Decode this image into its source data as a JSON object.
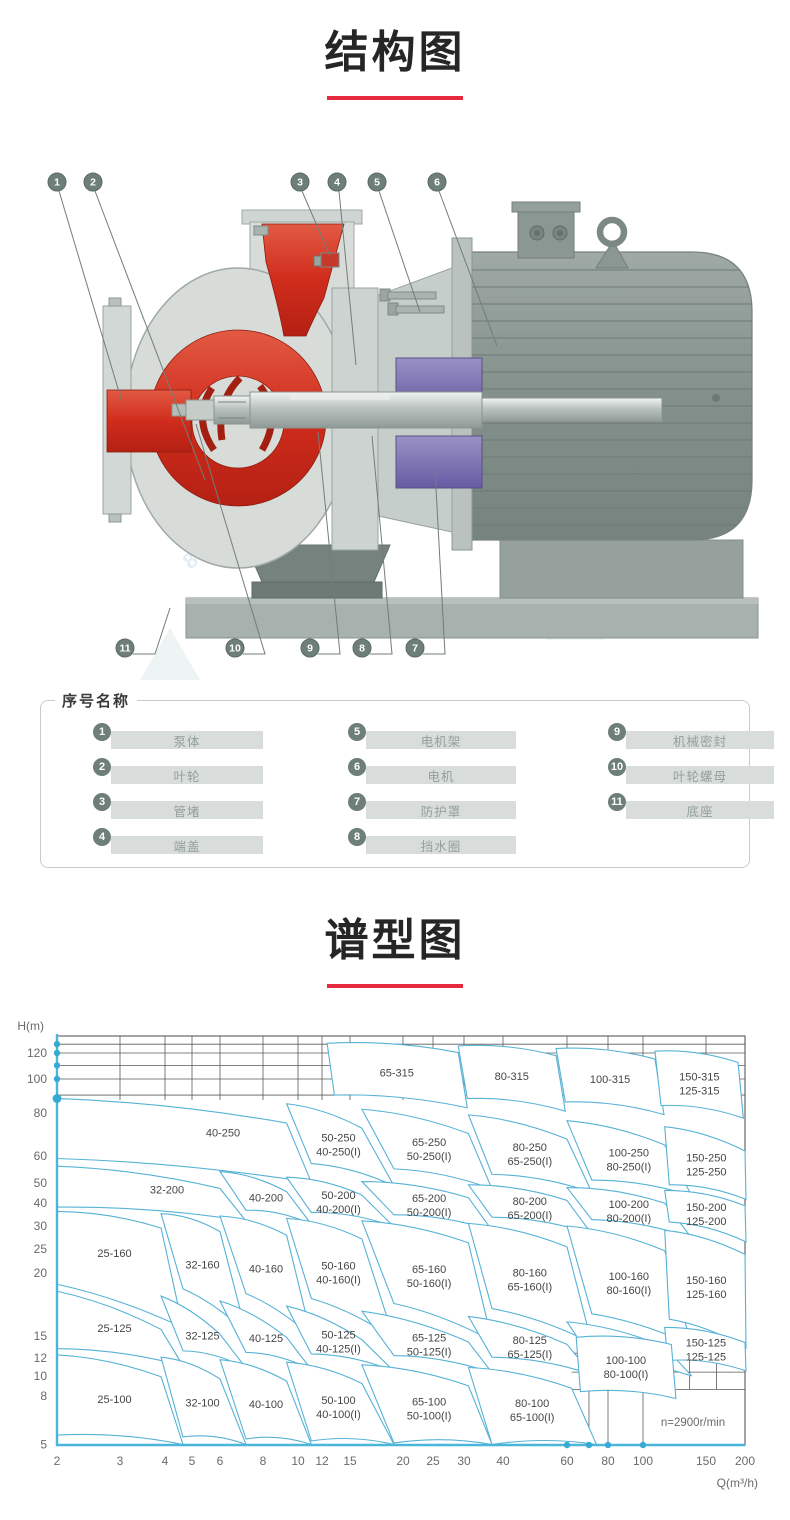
{
  "page": {
    "accent_red": "#e5293e"
  },
  "sections": {
    "structure": {
      "title": "结构图"
    },
    "spectrum": {
      "title": "谱型图"
    }
  },
  "structure": {
    "callouts_top": [
      "1",
      "2",
      "3",
      "4",
      "5",
      "6"
    ],
    "callouts_bottom": [
      "11",
      "10",
      "9",
      "8",
      "7"
    ],
    "watermark_text": "8570"
  },
  "legend": {
    "title": "序号名称",
    "columns": [
      [
        {
          "num": "1",
          "label": "泵体"
        },
        {
          "num": "2",
          "label": "叶轮"
        },
        {
          "num": "3",
          "label": "管堵"
        },
        {
          "num": "4",
          "label": "端盖"
        }
      ],
      [
        {
          "num": "5",
          "label": "电机架"
        },
        {
          "num": "6",
          "label": "电机"
        },
        {
          "num": "7",
          "label": "防护罩"
        },
        {
          "num": "8",
          "label": "挡水圈"
        }
      ],
      [
        {
          "num": "9",
          "label": "机械密封"
        },
        {
          "num": "10",
          "label": "叶轮螺母"
        },
        {
          "num": "11",
          "label": "底座"
        }
      ]
    ]
  },
  "chart_data": {
    "type": "area",
    "title": "谱型图",
    "xlabel": "Q(m³/h)",
    "ylabel": "H(m)",
    "scale": "log-log",
    "x_range": [
      2,
      200
    ],
    "y_range": [
      5,
      140
    ],
    "annotation": "n=2900r/min",
    "x_ticks": [
      2,
      3,
      4,
      5,
      6,
      8,
      10,
      12,
      15,
      20,
      25,
      30,
      40,
      60,
      80,
      100,
      150,
      200
    ],
    "y_ticks": [
      120,
      100,
      80,
      60,
      50,
      40,
      30,
      25,
      20,
      15,
      12,
      10,
      8,
      5
    ],
    "grid_top_h": [
      130,
      120,
      110,
      100,
      90
    ],
    "colors": {
      "axis": "#49b6da",
      "region_stroke": "#57b2d6",
      "grid": "#5a5a5a",
      "tick": "#6a6a6a",
      "label": "#454545"
    },
    "regions": [
      {
        "t": [
          "65-315"
        ],
        "q1": 12.5,
        "q2": 29,
        "hT": 131,
        "hB": 90,
        "s": 1.06,
        "d": 0.92
      },
      {
        "t": [
          "80-315"
        ],
        "q1": 29,
        "q2": 56,
        "hT": 128,
        "hB": 88,
        "s": 1.06,
        "d": 0.92
      },
      {
        "t": [
          "100-315"
        ],
        "q1": 56,
        "q2": 108,
        "hT": 125,
        "hB": 86,
        "s": 1.06,
        "d": 0.92
      },
      {
        "t": [
          "150-315",
          "125-315"
        ],
        "q1": 108,
        "q2": 190,
        "hT": 122,
        "hB": 84,
        "s": 1.04,
        "d": 0.92
      },
      {
        "t": [
          "40-250"
        ],
        "q1": 2,
        "q2": 9.3,
        "hT": 88,
        "hB": 59,
        "sl": 1,
        "d": 0.85,
        "dx": 45,
        "dy": -6
      },
      {
        "t": [
          "50-250",
          "40-250(I)"
        ],
        "q1": 9.3,
        "q2": 16,
        "hT": 85,
        "hB": 57,
        "d": 0.85
      },
      {
        "t": [
          "65-250",
          "50-250(I)"
        ],
        "q1": 16,
        "q2": 31,
        "hT": 82,
        "hB": 55,
        "d": 0.85
      },
      {
        "t": [
          "80-250",
          "65-250(I)"
        ],
        "q1": 31,
        "q2": 60,
        "hT": 79,
        "hB": 53,
        "d": 0.85
      },
      {
        "t": [
          "100-250",
          "80-250(I)"
        ],
        "q1": 60,
        "q2": 115,
        "hT": 76,
        "hB": 51,
        "d": 0.85
      },
      {
        "t": [
          "150-250",
          "125-250"
        ],
        "q1": 115,
        "q2": 200,
        "hT": 73,
        "hB": 49,
        "s": 1.03,
        "d": 0.85
      },
      {
        "t": [
          "32-200"
        ],
        "q1": 2,
        "q2": 6,
        "hT": 56,
        "hB": 38,
        "sl": 1,
        "dx": 22,
        "dy": -4
      },
      {
        "t": [
          "40-200"
        ],
        "q1": 6,
        "q2": 9.3,
        "hT": 54,
        "hB": 36.5
      },
      {
        "t": [
          "50-200",
          "40-200(I)"
        ],
        "q1": 9.3,
        "q2": 16,
        "hT": 52,
        "hB": 35.5
      },
      {
        "t": [
          "65-200",
          "50-200(I)"
        ],
        "q1": 16,
        "q2": 31,
        "hT": 50.5,
        "hB": 34.5
      },
      {
        "t": [
          "80-200",
          "65-200(I)"
        ],
        "q1": 31,
        "q2": 60,
        "hT": 49,
        "hB": 33.5
      },
      {
        "t": [
          "100-200",
          "80-200(I)"
        ],
        "q1": 60,
        "q2": 115,
        "hT": 47.5,
        "hB": 32.5
      },
      {
        "t": [
          "150-200",
          "125-200"
        ],
        "q1": 115,
        "q2": 200,
        "hT": 46,
        "hB": 31.5,
        "s": 1.03
      },
      {
        "t": [
          "25-160"
        ],
        "q1": 2,
        "q2": 3.9,
        "hT": 36,
        "hB": 19,
        "sl": 1,
        "dy": -8,
        "d": 0.82
      },
      {
        "t": [
          "32-160"
        ],
        "q1": 3.9,
        "q2": 6,
        "hT": 35,
        "hB": 18.6,
        "d": 0.82
      },
      {
        "t": [
          "40-160"
        ],
        "q1": 6,
        "q2": 9.3,
        "hT": 34,
        "hB": 18.2,
        "d": 0.82
      },
      {
        "t": [
          "50-160",
          "40-160(I)"
        ],
        "q1": 9.3,
        "q2": 16,
        "hT": 33,
        "hB": 17.8,
        "d": 0.82
      },
      {
        "t": [
          "65-160",
          "50-160(I)"
        ],
        "q1": 16,
        "q2": 31,
        "hT": 32,
        "hB": 17.4,
        "d": 0.82
      },
      {
        "t": [
          "80-160",
          "65-160(I)"
        ],
        "q1": 31,
        "q2": 60,
        "hT": 31,
        "hB": 17,
        "d": 0.82
      },
      {
        "t": [
          "100-160",
          "80-160(I)"
        ],
        "q1": 60,
        "q2": 115,
        "hT": 30,
        "hB": 16.6,
        "d": 0.82
      },
      {
        "t": [
          "150-160",
          "125-160"
        ],
        "q1": 115,
        "q2": 200,
        "hT": 29,
        "hB": 16.2,
        "s": 1.03,
        "d": 0.82
      },
      {
        "t": [
          "25-125"
        ],
        "q1": 2,
        "q2": 3.9,
        "hT": 18.4,
        "hB": 13.2,
        "sl": 1,
        "dy": -4
      },
      {
        "t": [
          "32-125"
        ],
        "q1": 3.9,
        "q2": 6,
        "hT": 18,
        "hB": 12.9
      },
      {
        "t": [
          "40-125"
        ],
        "q1": 6,
        "q2": 9.3,
        "hT": 17.6,
        "hB": 12.7
      },
      {
        "t": [
          "50-125",
          "40-125(I)"
        ],
        "q1": 9.3,
        "q2": 16,
        "hT": 17.2,
        "hB": 12.5
      },
      {
        "t": [
          "65-125",
          "50-125(I)"
        ],
        "q1": 16,
        "q2": 31,
        "hT": 16.8,
        "hB": 12.3
      },
      {
        "t": [
          "80-125",
          "65-125(I)"
        ],
        "q1": 31,
        "q2": 60,
        "hT": 16.4,
        "hB": 12.1
      },
      {
        "t": [
          "100-125",
          "80-125(I)"
        ],
        "q1": 60,
        "q2": 115,
        "hT": 16,
        "hB": 11.9
      },
      {
        "t": [
          "150-125",
          "125-125"
        ],
        "q1": 115,
        "q2": 200,
        "hT": 15.6,
        "hB": 11.7,
        "s": 1.02,
        "d": 0.9
      },
      {
        "t": [
          "25-100"
        ],
        "q1": 2,
        "q2": 3.9,
        "hT": 12.4,
        "hB": 5.5,
        "sl": 1,
        "dy": -2,
        "d": 0.8
      },
      {
        "t": [
          "32-100"
        ],
        "q1": 3.9,
        "q2": 6,
        "hT": 12.1,
        "hB": 5.4,
        "d": 0.8
      },
      {
        "t": [
          "40-100"
        ],
        "q1": 6,
        "q2": 9.3,
        "hT": 11.8,
        "hB": 5.3,
        "d": 0.8
      },
      {
        "t": [
          "50-100",
          "40-100(I)"
        ],
        "q1": 9.3,
        "q2": 16,
        "hT": 11.5,
        "hB": 5.2,
        "d": 0.8
      },
      {
        "t": [
          "65-100",
          "50-100(I)"
        ],
        "q1": 16,
        "q2": 31,
        "hT": 11.2,
        "hB": 5.1,
        "d": 0.8
      },
      {
        "t": [
          "80-100",
          "65-100(I)"
        ],
        "q1": 31,
        "q2": 62,
        "hT": 10.9,
        "hB": 5,
        "d": 0.8
      },
      {
        "t": [
          "100-100",
          "80-100(I)"
        ],
        "q1": 64,
        "q2": 120,
        "hT": 14.8,
        "hB": 8.4,
        "s": 1.03,
        "d": 0.93
      }
    ]
  }
}
